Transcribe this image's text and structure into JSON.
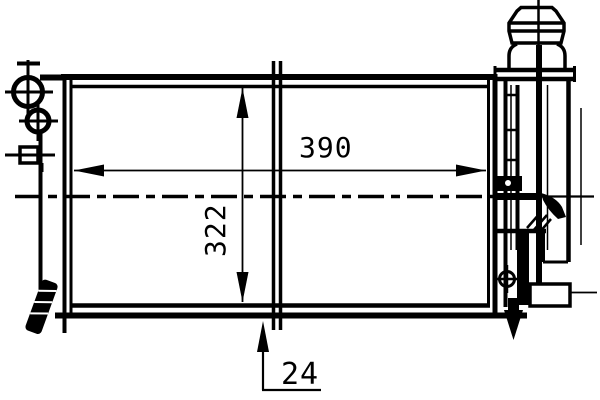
{
  "page": {
    "background_color": "#ffffff",
    "line_color": "#000000"
  },
  "drawing": {
    "description": "Technical line drawing of a radiator with side expansion tank and filler cap",
    "dimensions": {
      "width": {
        "label": "390"
      },
      "height": {
        "label": "322"
      },
      "depth": {
        "label": "24"
      }
    }
  }
}
